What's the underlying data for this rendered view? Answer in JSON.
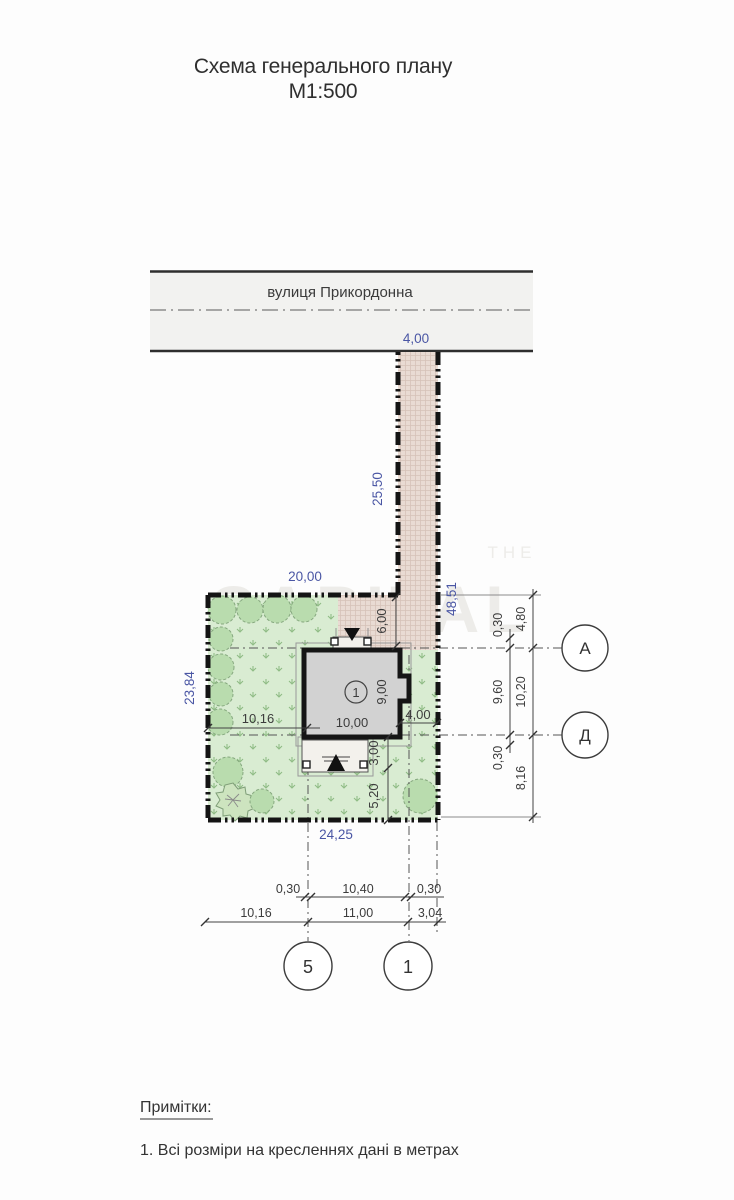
{
  "title": {
    "line1": "Схема генерального плану",
    "line2": "М1:500"
  },
  "street": {
    "name": "вулиця Прикордонна"
  },
  "watermark": {
    "top": "THE",
    "main": "CAPITAL"
  },
  "plot": {
    "driveway_width": "4,00",
    "driveway_length": "25,50",
    "boundary_right": "48,51",
    "width_top": "20,00",
    "length_left": "23,84",
    "width_bottom": "24,25"
  },
  "house": {
    "label": "1",
    "path_depth": "6,00",
    "offset_left": "10,16",
    "width": "10,00",
    "depth": "9,00",
    "offset_right": "4,00",
    "terrace_depth": "3,00",
    "terrace_to_boundary": "5,20"
  },
  "right_chain": {
    "wall_a": "0,30",
    "to_axis_a": "4,80",
    "inner_span": "9,60",
    "outer_span": "10,20",
    "wall_d": "0,30",
    "to_boundary": "8,16"
  },
  "bottom_chain": {
    "wall_5": "0,30",
    "inner_span": "10,40",
    "wall_1": "0,30",
    "offset_left": "10,16",
    "axes_span": "11,00",
    "offset_right": "3,04"
  },
  "axes": {
    "a": "А",
    "d": "Д",
    "v5": "5",
    "v1": "1"
  },
  "notes": {
    "heading": "Примітки:",
    "item_1": "1. Всі розміри на кресленнях дані в метрах"
  },
  "colors": {
    "dim_blue": "#4a56a4",
    "ink": "#3a3a3a",
    "plot_green": "#d9ecd2",
    "paving": "#e9dbd3",
    "house_gray": "#d2d2d2"
  }
}
